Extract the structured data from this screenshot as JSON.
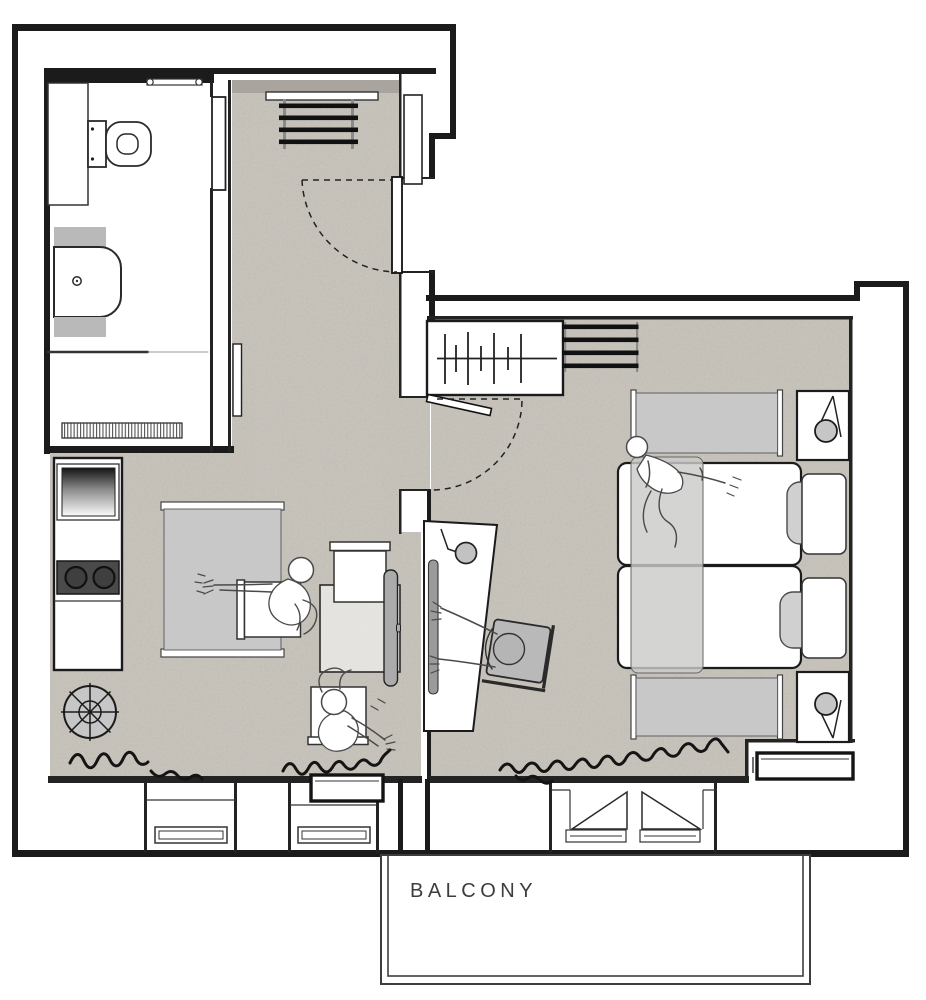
{
  "page": {
    "title": "Apartment floor plan"
  },
  "labels": {
    "balcony": "BALCONY"
  },
  "colors": {
    "wall": "#1b1b1b",
    "line": "#2a2a2a",
    "floor": "#cac6be",
    "floor_shade": "#a9a59e",
    "furniture_light": "#c8c8c8",
    "furniture_mid": "#ababab",
    "appliance_dark": "#4a4a4a",
    "label_text": "#3d3d3d",
    "paper": "#ffffff"
  },
  "rooms": [
    "bathroom",
    "hallway",
    "kitchen",
    "living-room",
    "bedroom",
    "balcony"
  ],
  "furniture_icons": [
    "toilet-icon",
    "bathroom-sink-icon",
    "shower-glass-icon",
    "shower-mat-icon",
    "towel-rail-icon",
    "vanity-counter-icon",
    "pocket-door-icon",
    "coat-rack-icon",
    "shoe-shelf-icon",
    "wall-shaft-icon",
    "wall-console-icon",
    "door-swing-icon",
    "wardrobe-icon",
    "hanger-rail-icon",
    "shelf-rack-icon",
    "twin-bed-icon",
    "pillow-icon",
    "headboard-icon",
    "nightstand-icon",
    "lamp-icon",
    "bench-icon",
    "blanket-icon",
    "person-lying-icon",
    "desk-icon",
    "monitor-icon",
    "desk-lamp-icon",
    "desk-chair-icon",
    "person-sitting-icon",
    "sofa-icon",
    "dining-table-icon",
    "chair-icon",
    "tv-panel-icon",
    "round-table-icon",
    "kitchen-sink-icon",
    "stove-icon",
    "radiator-icon",
    "window-icon",
    "balcony-door-icon",
    "squiggle-decor-icon"
  ]
}
